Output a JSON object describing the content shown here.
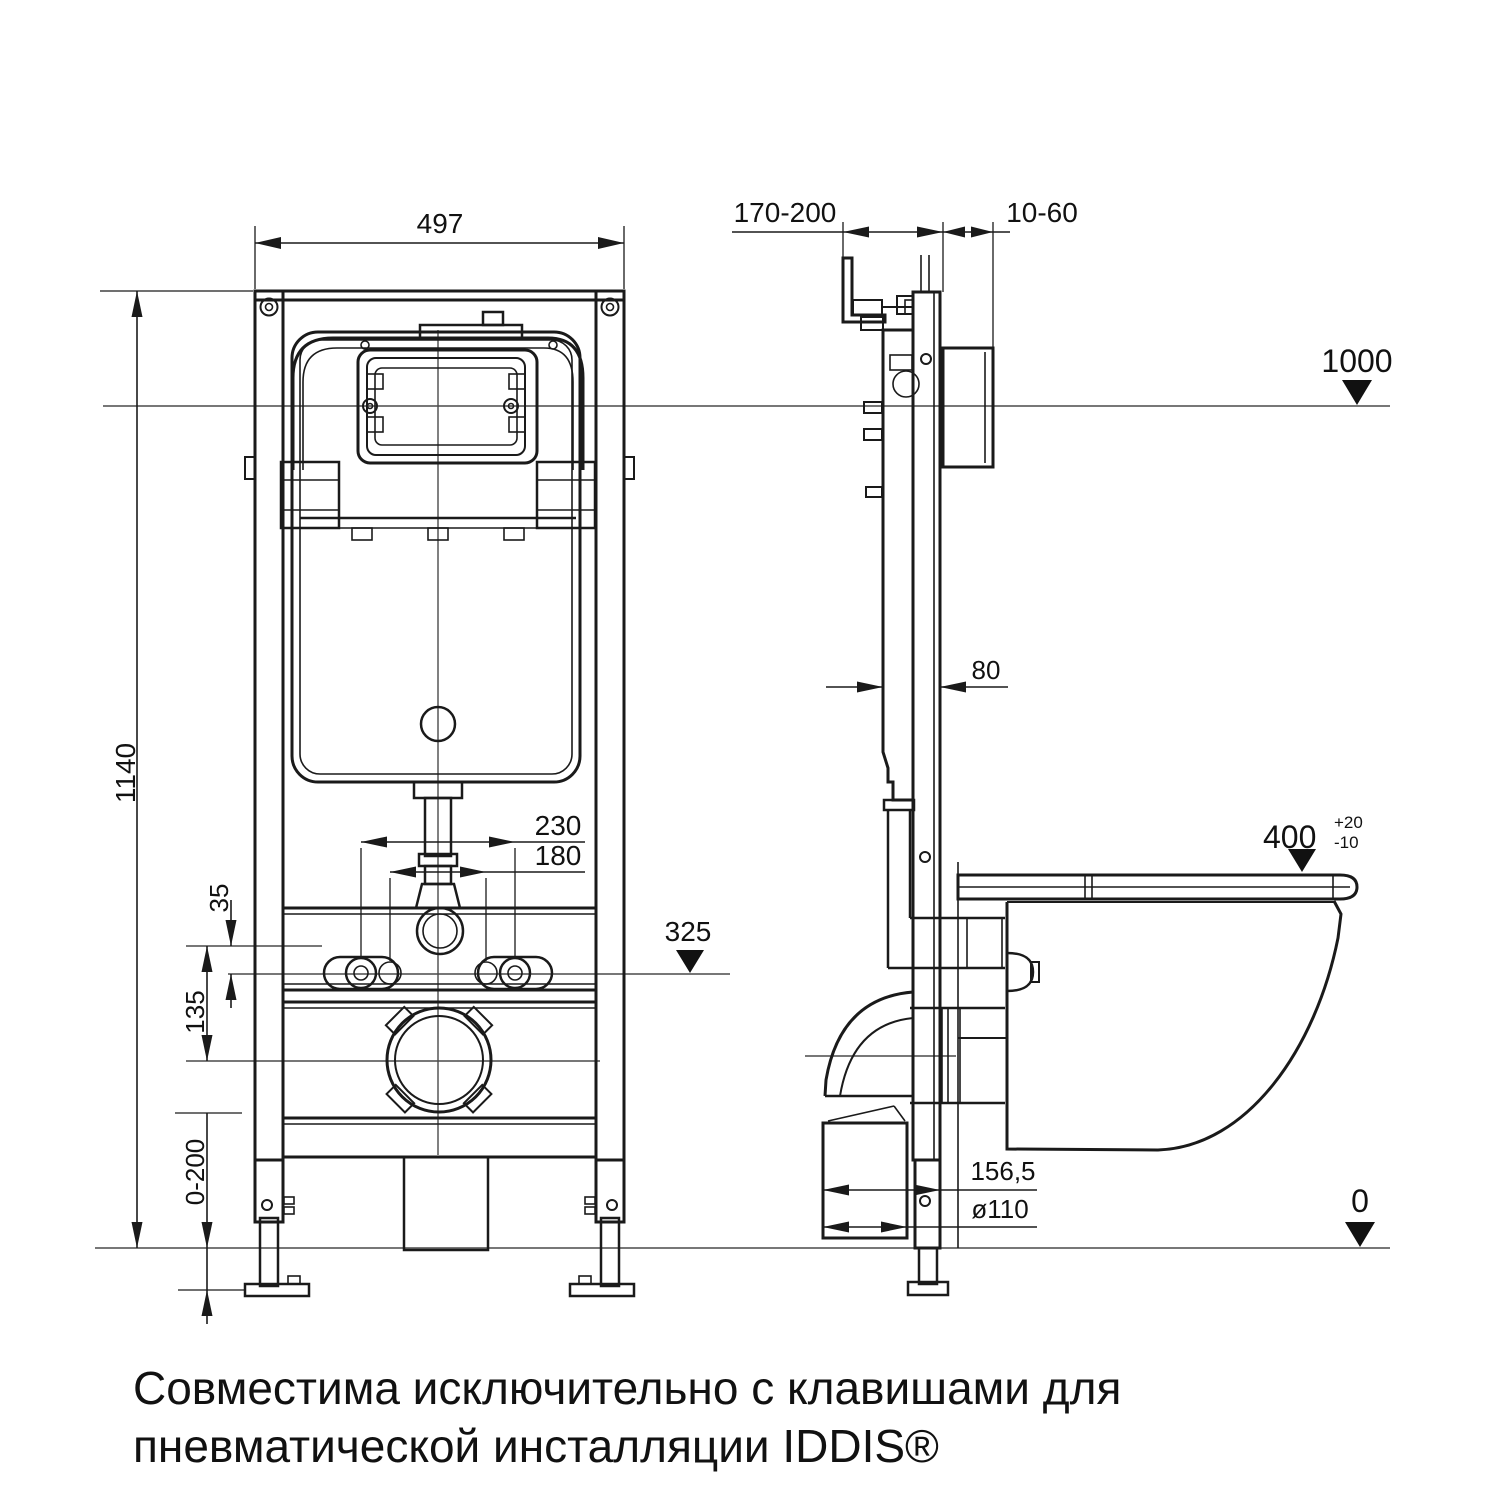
{
  "drawing": {
    "background": "#ffffff",
    "line_color": "#1a1a1a",
    "thin_line_color": "#4a4a4a"
  },
  "dims": {
    "frame_width": "497",
    "frame_height": "1140",
    "anchor_spacing": "230",
    "inner_spacing": "180",
    "offset_small": "35",
    "drain_offset": "135",
    "leg_adjust_range": "0-200",
    "install_depth_range": "170-200",
    "wall_finish_range": "10-60",
    "cistern_depth": "80",
    "outlet_wall_distance": "156,5",
    "outlet_pipe_diameter": "ø110"
  },
  "levels": {
    "flush_plate_height": "1000",
    "bowl_height": "400",
    "bowl_height_tol_plus": "+20",
    "bowl_height_tol_minus": "-10",
    "anchor_height": "325",
    "floor_level": "0"
  },
  "caption": {
    "line1": "Совместима исключительно с клавишами для",
    "line2": "пневматической инсталляции IDDIS®"
  }
}
